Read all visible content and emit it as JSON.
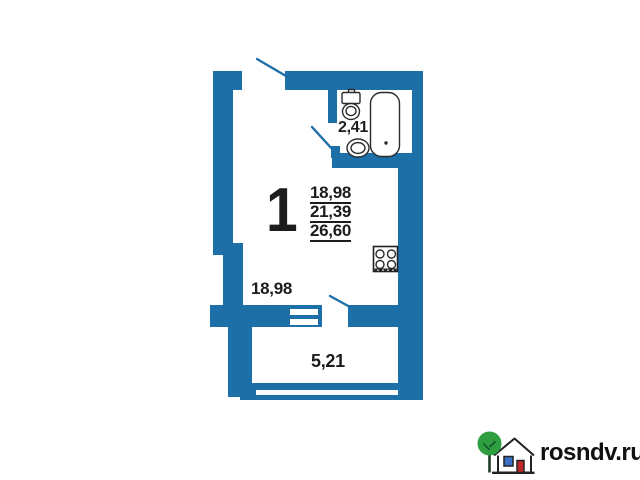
{
  "floor_plan": {
    "room_number": "1",
    "area_table": [
      "18,98",
      "21,39",
      "26,60"
    ],
    "bathroom_area": "2,41",
    "room_area": "18,98",
    "balcony_area": "5,21"
  },
  "watermark": {
    "text": "rosndv.ru"
  },
  "colors": {
    "wall_blue": "#1d6fa8",
    "label_black": "#1c1c1c",
    "fixture_outline": "#2b2b2b",
    "logo_tree_green": "#2f9e41",
    "logo_window_blue": "#3a6fc4",
    "logo_door_red": "#c1272d"
  },
  "icons": {
    "toilet": "toilet-icon",
    "sink": "sink-icon",
    "bathtub": "bathtub-icon",
    "stove": "stove-icon",
    "tree": "tree-icon",
    "house": "house-icon"
  }
}
